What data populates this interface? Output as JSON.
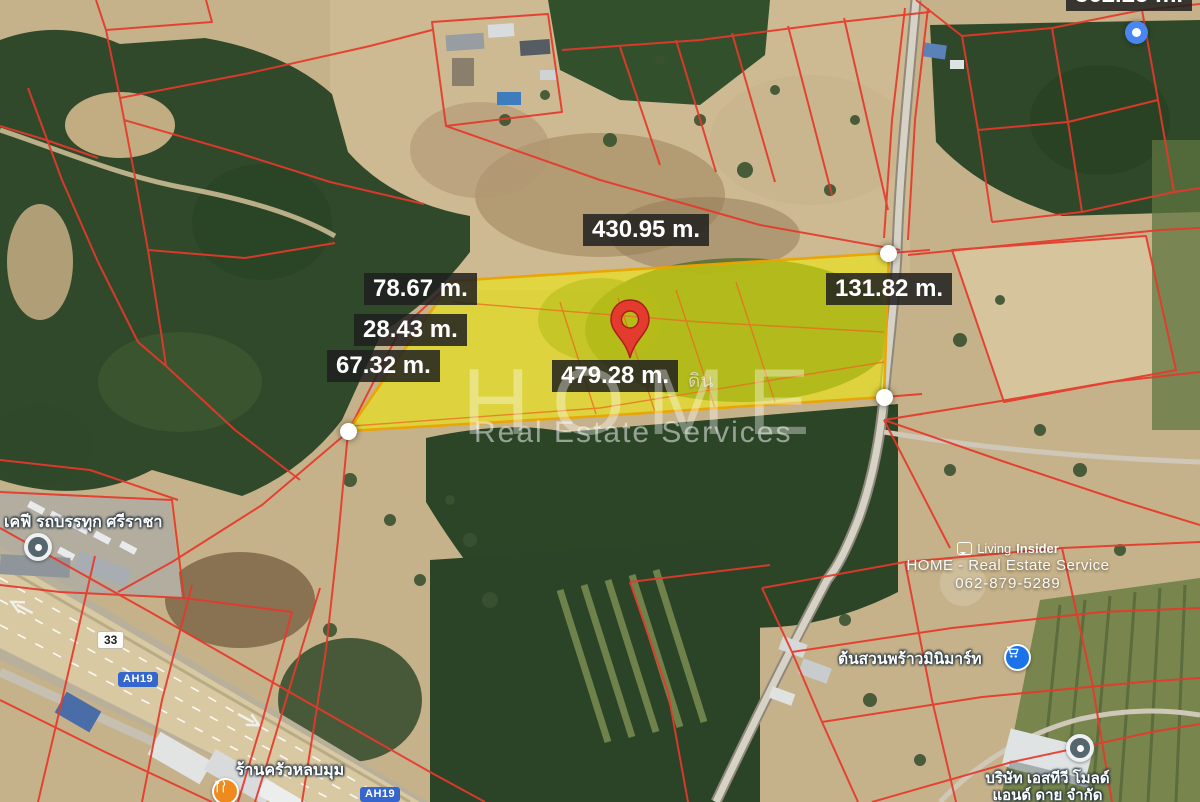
{
  "meta": {
    "width": 1200,
    "height": 802,
    "view": "satellite-land-plot-listing"
  },
  "measurements": {
    "top_partial": "362.25 m.",
    "top": "430.95 m.",
    "left_upper": "78.67 m.",
    "left_middle": "28.43 m.",
    "left_lower": "67.32 m.",
    "right": "131.82 m.",
    "bottom": "479.28 m."
  },
  "plot": {
    "hint_label": "ดิน"
  },
  "pois": {
    "truck": {
      "label": "เคฟี รถบรรทุก ศรีราชา"
    },
    "restaurant": {
      "label": "ร้านครัวหลบมุม"
    },
    "minimart": {
      "label": "ต้นสวนพร้าวมินิมาร์ท"
    },
    "company": {
      "label_line1": "บริษัท เอสทีวี โมลด์",
      "label_line2": "แอนด์ ดาย จำกัด"
    }
  },
  "road_shields": {
    "route_33": "33",
    "ah19_upper": "AH19",
    "ah19_lower": "AH19"
  },
  "watermark_center": {
    "brand": "HOME",
    "tagline": "Real Estate Services"
  },
  "watermark_corner": {
    "brand_regular": "Living",
    "brand_bold": "Insider",
    "service": "HOME - Real Estate Service",
    "phone": "062-879-5289"
  },
  "icons": {
    "pin": "red-map-pin",
    "vertex": "white-vertex-dot",
    "gps": "blue-gps-dot",
    "restaurant": "fork-knife",
    "minimart": "shopping-cart",
    "generic_poi": "gray-dot",
    "brand": "living-insider-bubble"
  },
  "colors": {
    "parcel_line": "#e6392b",
    "parcel_inner": "#e8701f",
    "plot_fill": "#f2ee00",
    "plot_stroke": "#eaa400",
    "label_bg": "rgba(30,30,30,0.85)",
    "label_text": "#ffffff",
    "pin_red": "#e33b2e",
    "pin_outline": "#a91f16",
    "gps_blue": "#4a86f0",
    "poi_blue": "#1a73e8",
    "poi_orange": "#ef8a1f",
    "poi_gray": "#56666f",
    "shield_blue": "#3566cc"
  }
}
